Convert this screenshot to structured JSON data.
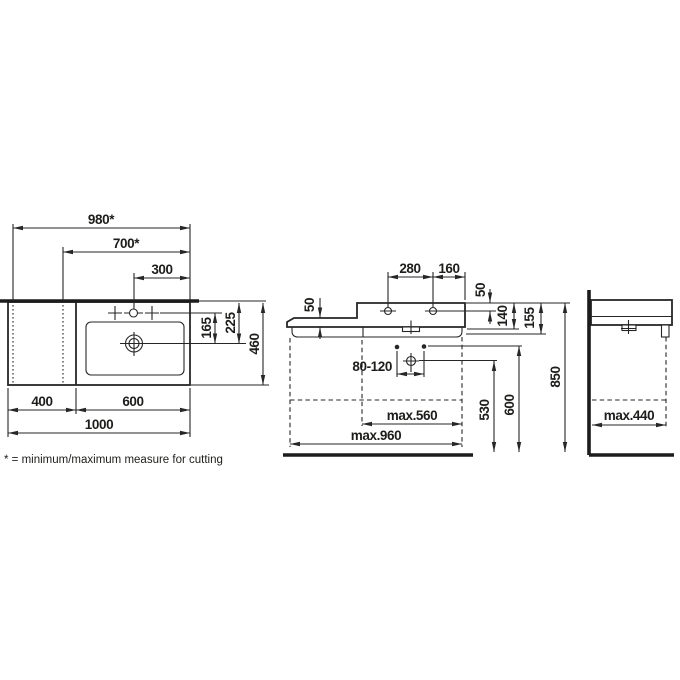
{
  "colors": {
    "line": "#262626",
    "background": "#ffffff"
  },
  "footnote": "* = minimum/maximum measure for cutting",
  "plan": {
    "cut_max": "980*",
    "cut_min": "700*",
    "tap_offset": "300",
    "tap_to_drain": "165",
    "rim_to_drain": "225",
    "depth": "460",
    "shelf_width": "400",
    "basin_width": "600",
    "total_width": "1000"
  },
  "front": {
    "tap_distance": "280",
    "tap_to_edge": "160",
    "shelf_thickness": "50",
    "tap_drop": "50",
    "body_height": "140",
    "total_height": "155",
    "mount_range": "80-120",
    "max_cabinet_right": "max.560",
    "max_cabinet_total": "max.960",
    "trap_height": "530",
    "mount_height": "600",
    "rim_height": "850"
  },
  "side": {
    "max_cabinet_depth": "max.440"
  }
}
